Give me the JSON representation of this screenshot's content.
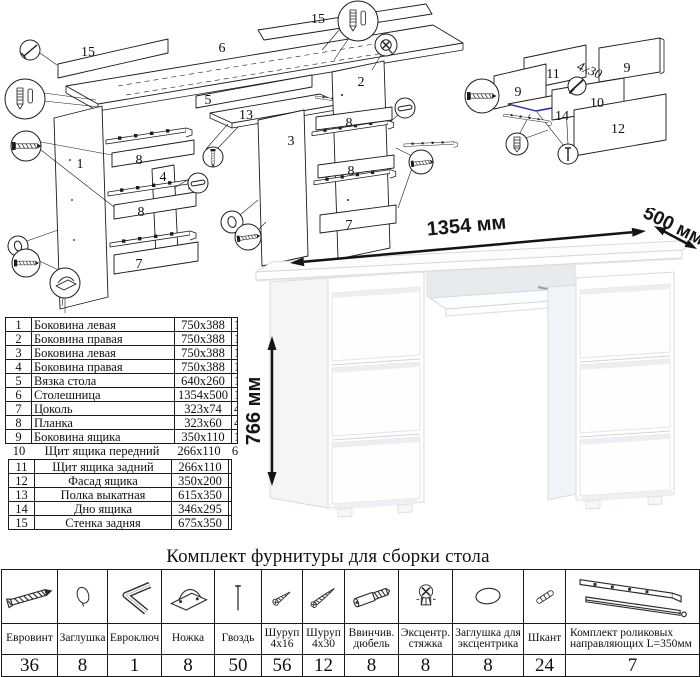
{
  "colors": {
    "line": "#1c1c1c",
    "highlight_blue": "#2323cc",
    "desk_line": "#d6dbdf",
    "dim_text": "#151515"
  },
  "exploded_left": {
    "labels": {
      "p15_back": "15",
      "p6_top": "6",
      "p15_top": "15",
      "p5": "5",
      "p13": "13",
      "p2": "2",
      "p3": "3",
      "p1": "1",
      "p4": "4",
      "p8_a": "8",
      "p8_b": "8",
      "p8_c": "8",
      "p8_d": "8",
      "p7_a": "7",
      "p7_b": "7"
    }
  },
  "exploded_right": {
    "labels": {
      "p11": "11",
      "p9_a": "9",
      "p9_b": "9",
      "p10": "10",
      "p14": "14",
      "p12": "12"
    },
    "screw_note": "4х30"
  },
  "desk_dimensions": {
    "width": "1354 мм",
    "depth": "500 мм",
    "height": "766 мм"
  },
  "parts_table": {
    "rows": [
      [
        "1",
        "Боковина левая",
        "750x388",
        "1"
      ],
      [
        "2",
        "Боковина правая",
        "750x388",
        "1"
      ],
      [
        "3",
        "Боковина левая",
        "750x388",
        "1"
      ],
      [
        "4",
        "Боковина правая",
        "750x388",
        "1"
      ],
      [
        "5",
        "Вязка стола",
        "640x260",
        "1"
      ],
      [
        "6",
        "Столешница",
        "1354x500",
        "1"
      ],
      [
        "7",
        "Цоколь",
        "323x74",
        "4"
      ],
      [
        "8",
        "Планка",
        "323x60",
        "4"
      ],
      [
        "9",
        "Боковина ящика",
        "350x110",
        "12"
      ],
      [
        "10",
        "Щит ящика передний",
        "266x110",
        "6"
      ],
      [
        "11",
        "Щит ящика задний",
        "266x110",
        "6"
      ],
      [
        "12",
        "Фасад ящика",
        "350x200",
        "6"
      ],
      [
        "13",
        "Полка выкатная",
        "615x350",
        "1"
      ],
      [
        "14",
        "Дно ящика",
        "346x295",
        "6"
      ],
      [
        "15",
        "Стенка задняя",
        "675x350",
        "2"
      ]
    ]
  },
  "hardware_kit": {
    "title": "Комплект фурнитуры для сборки стола",
    "items": [
      {
        "name": "Евровинт",
        "qty": "36",
        "icon": "euro-screw"
      },
      {
        "name": "Заглушка",
        "qty": "8",
        "icon": "cap"
      },
      {
        "name": "Евроключ",
        "qty": "1",
        "icon": "hex-key"
      },
      {
        "name": "Ножка",
        "qty": "8",
        "icon": "foot"
      },
      {
        "name": "Гвоздь",
        "qty": "50",
        "icon": "nail"
      },
      {
        "name": "Шуруп 4х16",
        "qty": "56",
        "icon": "screw-4x16"
      },
      {
        "name": "Шуруп 4х30",
        "qty": "12",
        "icon": "screw-4x30"
      },
      {
        "name": "Ввинчив. дюбель",
        "qty": "8",
        "icon": "screw-dowel"
      },
      {
        "name": "Эксцентр. стяжка",
        "qty": "8",
        "icon": "cam-lock"
      },
      {
        "name": "Заглушка для эксцентрика",
        "qty": "8",
        "icon": "cam-cap"
      },
      {
        "name": "Шкант",
        "qty": "24",
        "icon": "wood-dowel"
      },
      {
        "name": "Комплект роликовых направляющих L=350мм",
        "qty": "7",
        "icon": "drawer-slides"
      }
    ]
  }
}
